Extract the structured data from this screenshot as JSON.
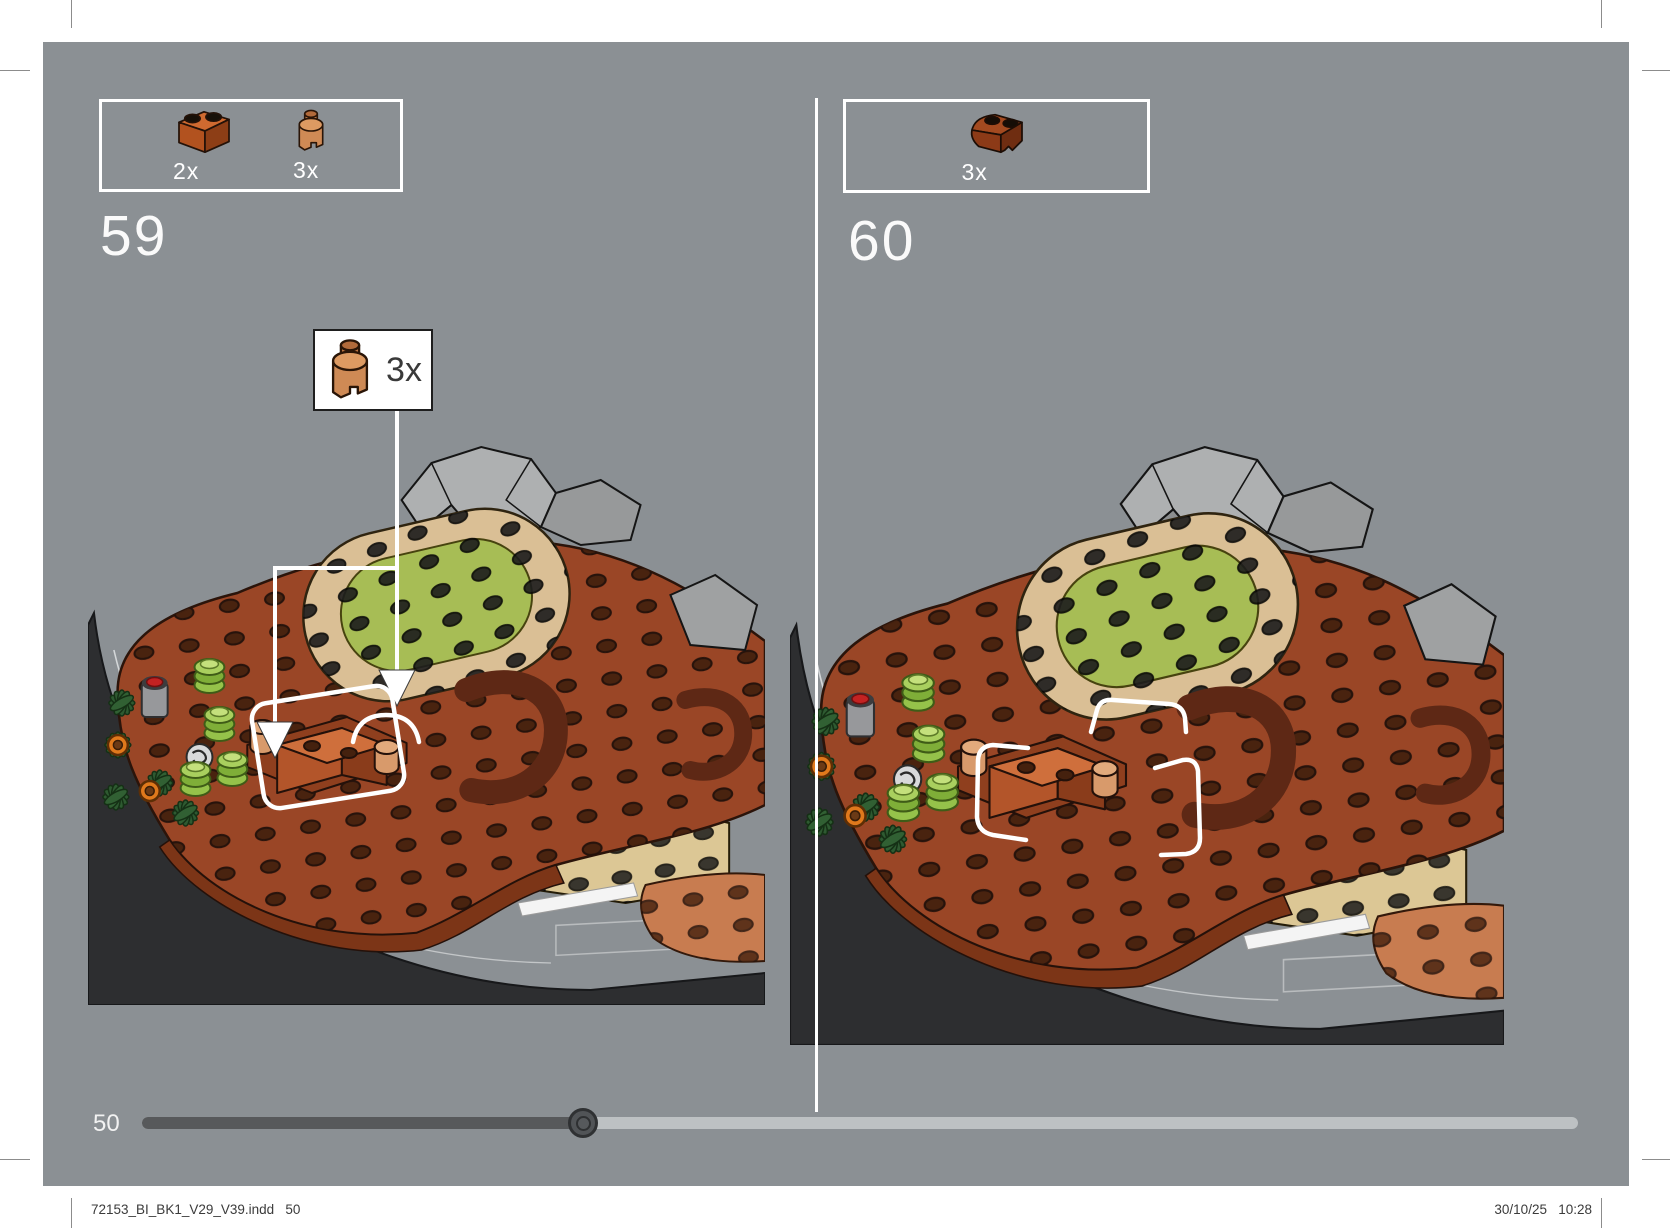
{
  "document": {
    "type": "lego-building-instructions",
    "page_background": "#8b9094",
    "footer_left": "72153_BI_BK1_V29_V39.indd   50",
    "footer_right": "30/10/25   10:28",
    "progress": {
      "page_label": "50",
      "fraction": 0.31
    }
  },
  "steps": [
    {
      "number": "59",
      "parts": [
        {
          "qty": "2x",
          "part": "brick-1x2",
          "color": "#c1602b"
        },
        {
          "qty": "3x",
          "part": "brick-1x1-curved",
          "color": "#cf8a55"
        }
      ],
      "callout": {
        "qty": "3x",
        "part": "brick-1x1-curved"
      }
    },
    {
      "number": "60",
      "parts": [
        {
          "qty": "3x",
          "part": "brick-2x2-curved-corner",
          "color": "#93411f"
        }
      ]
    }
  ],
  "colors": {
    "deck_brown": "#9a4626",
    "hull_charcoal": "#2d2e30",
    "tan_plate": "#dabf95",
    "olive_plate": "#a7bd55",
    "beige_deck": "#dcc795",
    "salmon_plate": "#c87c50",
    "highlight_white": "#ffffff"
  }
}
